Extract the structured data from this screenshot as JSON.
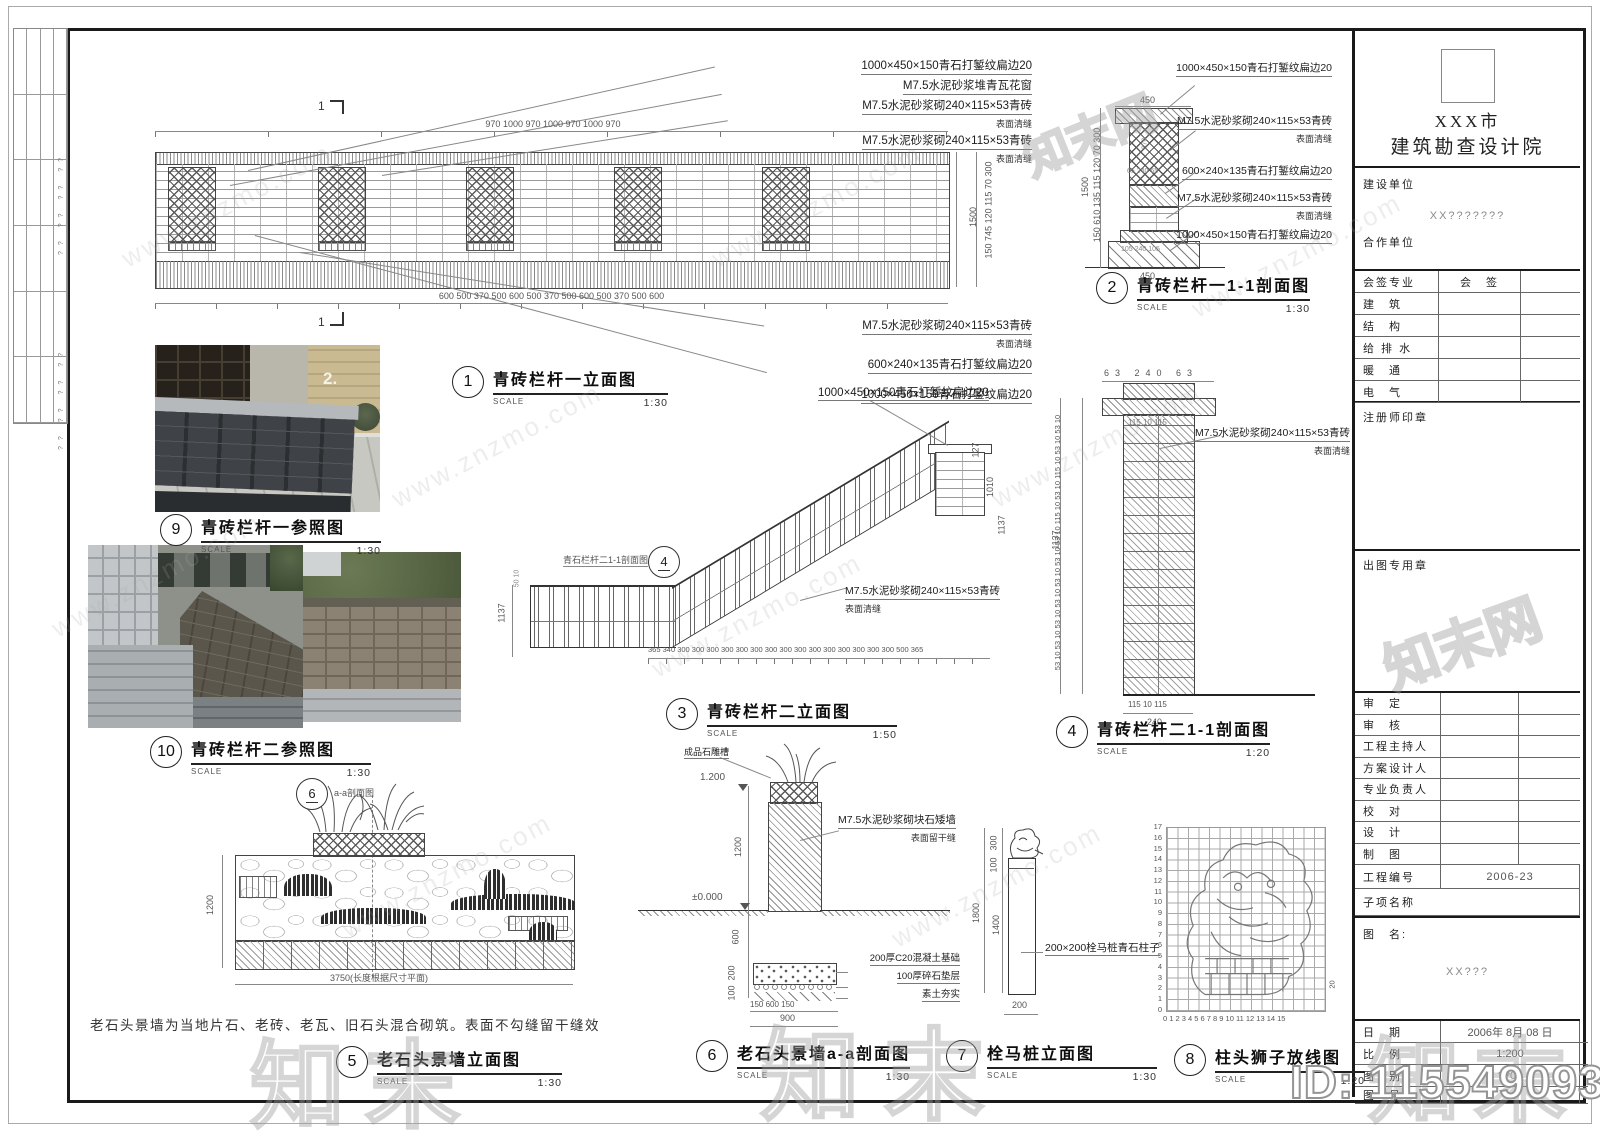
{
  "labels": {
    "scale_word": "SCALE",
    "section_mark": "1"
  },
  "watermark": {
    "url_text": "www.znzmo.com",
    "brand": "知末",
    "brand_net": "知末网",
    "id_text": "ID: 1155490932"
  },
  "side_strip": {
    "marks_a": "?? ?? ?? ??",
    "marks_b": "?? ?? ?? ??"
  },
  "details": [
    {
      "no": "1",
      "title": "青砖栏杆一立面图",
      "scale": "1:30"
    },
    {
      "no": "2",
      "title": "青砖栏杆一1-1剖面图",
      "scale": "1:30"
    },
    {
      "no": "3",
      "title": "青砖栏杆二立面图",
      "scale": "1:50"
    },
    {
      "no": "4",
      "title": "青砖栏杆二1-1剖面图",
      "scale": "1:20"
    },
    {
      "no": "5",
      "title": "老石头景墙立面图",
      "scale": "1:30"
    },
    {
      "no": "6",
      "title": "老石头景墙a-a剖面图",
      "scale": "1:30"
    },
    {
      "no": "7",
      "title": "栓马桩立面图",
      "scale": "1:30"
    },
    {
      "no": "8",
      "title": "柱头狮子放线图",
      "scale": "1:20"
    },
    {
      "no": "9",
      "title": "青砖栏杆一参照图",
      "scale": "1:30"
    },
    {
      "no": "10",
      "title": "青砖栏杆二参照图",
      "scale": "1:30"
    }
  ],
  "d1": {
    "ann_top": [
      "1000×450×150青石打錾纹扁边20",
      "M7.5水泥砂浆堆青瓦花窗",
      "M7.5水泥砂浆砌240×115×53青砖",
      "表面清缝",
      "M7.5水泥砂浆砌240×115×53青砖",
      "表面清缝"
    ],
    "ann_bottom": [
      "M7.5水泥砂浆砌240×115×53青砖",
      "表面清缝",
      "600×240×135青石打錾纹扁边20",
      "1000×450×150青石打錾纹扁边20"
    ],
    "dims_top": [
      "970",
      "1000",
      "970",
      "1000",
      "970",
      "1000",
      "970"
    ],
    "dims_bottom": [
      "600",
      "500",
      "370",
      "500",
      "600",
      "500",
      "370",
      "500",
      "600",
      "500",
      "370",
      "500",
      "600"
    ],
    "dims_right": "150 745 120 115 70 300",
    "dim_total": "1500"
  },
  "d2": {
    "dim_top": "450",
    "dim_bottom": "450",
    "dims_left": "150 610 135 115 120 70 300",
    "dim_total": "1500",
    "dims_inner": [
      "370",
      "65 240 65",
      "105 240 105"
    ],
    "ann": [
      "1000×450×150青石打錾纹扁边20",
      "M7.5水泥砂浆砌240×115×53青砖",
      "表面清缝",
      "600×240×135青石打錾纹扁边20",
      "M7.5水泥砂浆砌240×115×53青砖",
      "表面清缝",
      "1000×450×150青石打錾纹扁边20"
    ]
  },
  "d3": {
    "ann_top": "1000×450×150青石打錾纹扁边20",
    "ref_no": "4",
    "ref_label": "青石栏杆二1-1剖面图",
    "ann": [
      "M7.5水泥砂浆砌240×115×53青砖",
      "表面清缝"
    ],
    "dim_left": "1137",
    "dims_left_small": "50 10",
    "dims_right": [
      "127",
      "1010",
      "1137"
    ],
    "dims_bottom": [
      "365",
      "340",
      "300",
      "300",
      "300",
      "300",
      "300",
      "300",
      "300",
      "300",
      "300",
      "300",
      "300",
      "300",
      "300",
      "300",
      "300",
      "500",
      "365"
    ]
  },
  "d4": {
    "dims_top": "63  240  63",
    "dims_top2": "115 10 115",
    "dims_bottom": "115 10 115",
    "dim_bottom2": "240",
    "dim_total": "1137",
    "left_stack": "53 10 53 10 53 10 53 10 53 10 53 10 53 10 115 10 53 10 115 10 53 10 53 10",
    "ann": [
      "M7.5水泥砂浆砌240×115×53青砖",
      "表面清缝"
    ]
  },
  "d5": {
    "ref_no": "6",
    "ref_label": "a-a剖面图",
    "dim_left": "1200",
    "dim_bottom": "3750(长度根据尺寸平面)",
    "note": "老石头景墙为当地片石、老砖、老瓦、旧石头混合砌筑。表面不勾缝留干缝效"
  },
  "d6": {
    "ann_pot": "成品石雕槽",
    "level_top": "1.200",
    "level_zero": "±0.000",
    "dims_left": [
      "1200",
      "600",
      "200",
      "100"
    ],
    "ann_right": [
      "M7.5水泥砂浆砌块石矮墙",
      "表面留干缝"
    ],
    "ann_footing": [
      "200厚C20混凝土基础",
      "100厚碎石垫层",
      "素土夯实"
    ],
    "dims_bottom": "150  600  150",
    "dim_bottom2": "900"
  },
  "d7": {
    "dims_left": [
      "300",
      "100",
      "1400"
    ],
    "dim_total": "1800",
    "dim_bottom": "200",
    "ann": "200×200栓马桩青石柱子"
  },
  "d8": {
    "axis_x": [
      "0",
      "1",
      "2",
      "3",
      "4",
      "5",
      "6",
      "7",
      "8",
      "9",
      "10",
      "11",
      "12",
      "13",
      "14",
      "15"
    ],
    "axis_y": [
      "17",
      "16",
      "15",
      "14",
      "13",
      "12",
      "11",
      "10",
      "9",
      "8",
      "7",
      "6",
      "5",
      "4",
      "3",
      "2",
      "1",
      "0"
    ],
    "side_dim": "20"
  },
  "photos": {
    "p9_sign": "2."
  },
  "title_block": {
    "institute_line1": "XXX市",
    "institute_line2": "建筑勘查设计院",
    "owner_label": "建设单位",
    "owner_value": "XX???????",
    "partner_label": "合作单位",
    "sign_header_label": "会签专业",
    "sign_header_value": "会　签",
    "sign_rows": [
      "建　筑",
      "结　构",
      "给 排 水",
      "暖　通",
      "电　气"
    ],
    "stamp_registered": "注册师印章",
    "stamp_issue": "出图专用章",
    "personnel": [
      "审　定",
      "审　核",
      "工程主持人",
      "方案设计人",
      "专业负责人",
      "校　对",
      "设　计",
      "制　图"
    ],
    "project_no_label": "工程编号",
    "project_no": "2006-23",
    "sub_name_label": "子项名称",
    "drawing_name_label": "图　名:",
    "drawing_name": "XX???",
    "date_label": "日　期",
    "date_value": "2006年 8月 08 日",
    "ratio_label": "比　例",
    "ratio_value": "1:200",
    "category_label": "图　别",
    "category_value": "??01",
    "number_label": "图　号"
  }
}
